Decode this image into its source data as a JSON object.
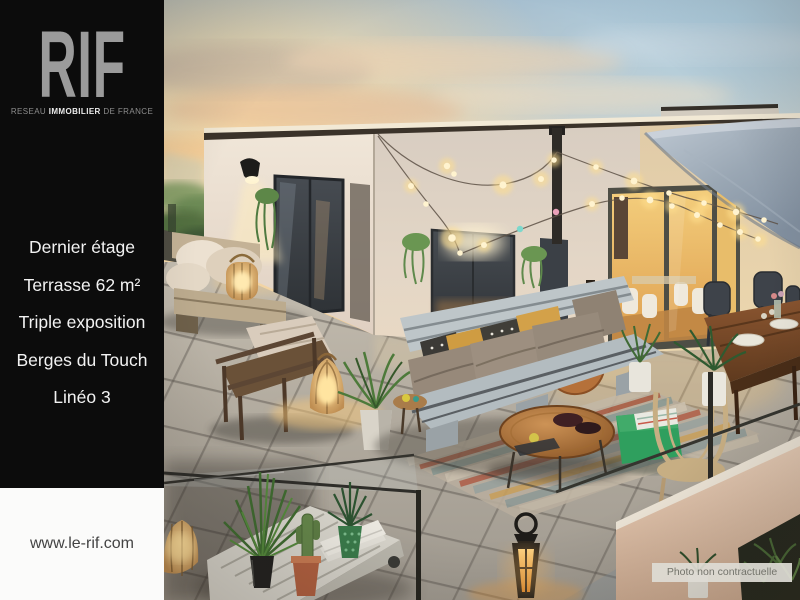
{
  "brand": {
    "logo": "RIF",
    "tagline_pre": "RESEAU ",
    "tagline_bold": "IMMOBILIER",
    "tagline_post": " DE FRANCE"
  },
  "sidebar": {
    "items": [
      "Dernier étage",
      "Terrasse 62 m²",
      "Triple exposition",
      "Berges du Touch",
      "Linéo 3"
    ],
    "website": "www.le-rif.com"
  },
  "image": {
    "disclaimer": "Photo non contractuelle"
  },
  "colors": {
    "sidebar_bg": "#0c0c0c",
    "logo_gray": "#9b9b9b",
    "menu_text": "#f2f2f2",
    "footer_band": "#fbfbfa",
    "url_text": "#434343",
    "sunset_warm": "#f2c98f",
    "sky_blue": "#b7d3e2",
    "pouf_green": "#2f9f5e",
    "sail_gray": "#9aa7b4",
    "disclaimer_bg": "#dedcd4",
    "disclaimer_text": "#73736b"
  }
}
